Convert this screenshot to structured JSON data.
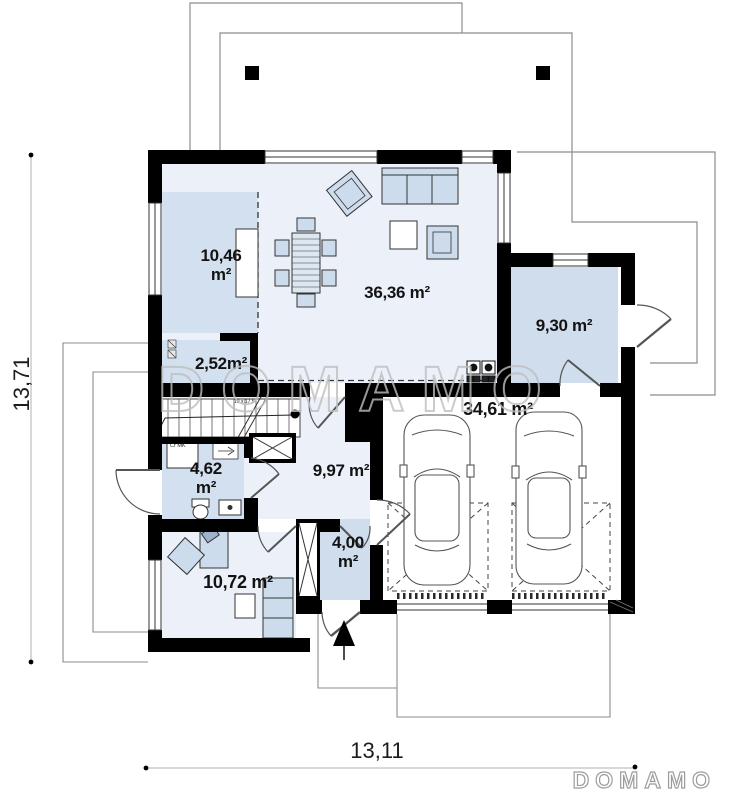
{
  "watermark": "DOMAMO",
  "logo": "DOMAMO",
  "dimensions": {
    "height_m": "13,71",
    "width_m": "13,11"
  },
  "rooms": [
    {
      "name": "living-dining",
      "label": "36,36 m²"
    },
    {
      "name": "kitchen",
      "label": "10,46\nm²"
    },
    {
      "name": "pantry",
      "label": "2,52m²"
    },
    {
      "name": "utility-room",
      "label": "9,30 m²"
    },
    {
      "name": "bathroom",
      "label": "4,62\nm²"
    },
    {
      "name": "hall",
      "label": "9,97 m²"
    },
    {
      "name": "garage",
      "label": "34,61 m²"
    },
    {
      "name": "vestibule",
      "label": "4,00\nm²"
    },
    {
      "name": "bedroom",
      "label": "10,72 m²"
    }
  ],
  "annotations": {
    "stairs_note": "19 x 17,5",
    "washer_label": "Cr MK"
  }
}
